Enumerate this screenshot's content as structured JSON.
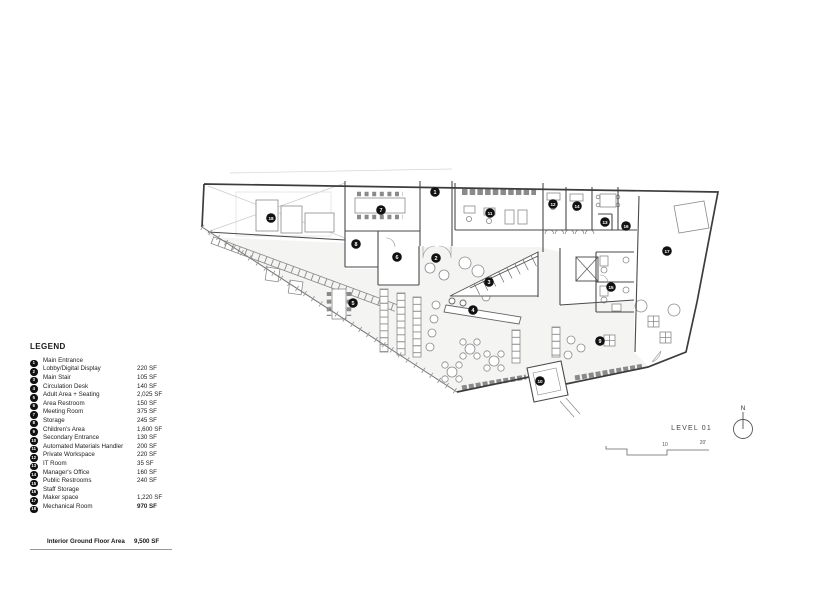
{
  "legend": {
    "title": "LEGEND",
    "items": [
      {
        "num": "1",
        "label": "Main Entrance",
        "area": ""
      },
      {
        "num": "2",
        "label": "Lobby/Digital Display",
        "area": "220 SF"
      },
      {
        "num": "3",
        "label": "Main Stair",
        "area": "105 SF"
      },
      {
        "num": "4",
        "label": "Circulation Desk",
        "area": "140 SF"
      },
      {
        "num": "5",
        "label": "Adult Area + Seating",
        "area": "2,025 SF"
      },
      {
        "num": "6",
        "label": "Area Restroom",
        "area": "150 SF"
      },
      {
        "num": "7",
        "label": "Meeting Room",
        "area": "375 SF"
      },
      {
        "num": "8",
        "label": "Storage",
        "area": "245 SF"
      },
      {
        "num": "9",
        "label": "Children's Area",
        "area": "1,600 SF"
      },
      {
        "num": "10",
        "label": "Secondary Entrance",
        "area": "130 SF"
      },
      {
        "num": "11",
        "label": "Automated Materials Handler",
        "area": "200 SF"
      },
      {
        "num": "12",
        "label": "Private Workspace",
        "area": "220 SF"
      },
      {
        "num": "13",
        "label": "IT Room",
        "area": "35 SF"
      },
      {
        "num": "14",
        "label": "Manager's Office",
        "area": "160 SF"
      },
      {
        "num": "15",
        "label": "Public Restrooms",
        "area": "240 SF"
      },
      {
        "num": "16",
        "label": "Staff Storage",
        "area": ""
      },
      {
        "num": "17",
        "label": "Maker space",
        "area": "1,220 SF"
      },
      {
        "num": "18",
        "label": "Mechanical Room",
        "area": "970 SF"
      }
    ],
    "total_label": "Interior Ground Floor Area",
    "total_area": "9,500 SF"
  },
  "plan": {
    "level_label": "LEVEL 01",
    "north_label": "N",
    "scale_ticks": [
      "10",
      "20'"
    ],
    "markers": [
      {
        "num": "1",
        "x": 435,
        "y": 192
      },
      {
        "num": "2",
        "x": 436,
        "y": 258
      },
      {
        "num": "3",
        "x": 489,
        "y": 282
      },
      {
        "num": "4",
        "x": 473,
        "y": 310
      },
      {
        "num": "5",
        "x": 353,
        "y": 303
      },
      {
        "num": "6",
        "x": 397,
        "y": 257
      },
      {
        "num": "7",
        "x": 381,
        "y": 210
      },
      {
        "num": "8",
        "x": 356,
        "y": 244
      },
      {
        "num": "9",
        "x": 600,
        "y": 341
      },
      {
        "num": "10",
        "x": 540,
        "y": 381
      },
      {
        "num": "11",
        "x": 490,
        "y": 213
      },
      {
        "num": "12",
        "x": 553,
        "y": 204
      },
      {
        "num": "13",
        "x": 605,
        "y": 222
      },
      {
        "num": "14",
        "x": 577,
        "y": 206
      },
      {
        "num": "15",
        "x": 611,
        "y": 287
      },
      {
        "num": "16",
        "x": 626,
        "y": 226
      },
      {
        "num": "17",
        "x": 667,
        "y": 251
      },
      {
        "num": "18",
        "x": 271,
        "y": 218
      }
    ]
  }
}
